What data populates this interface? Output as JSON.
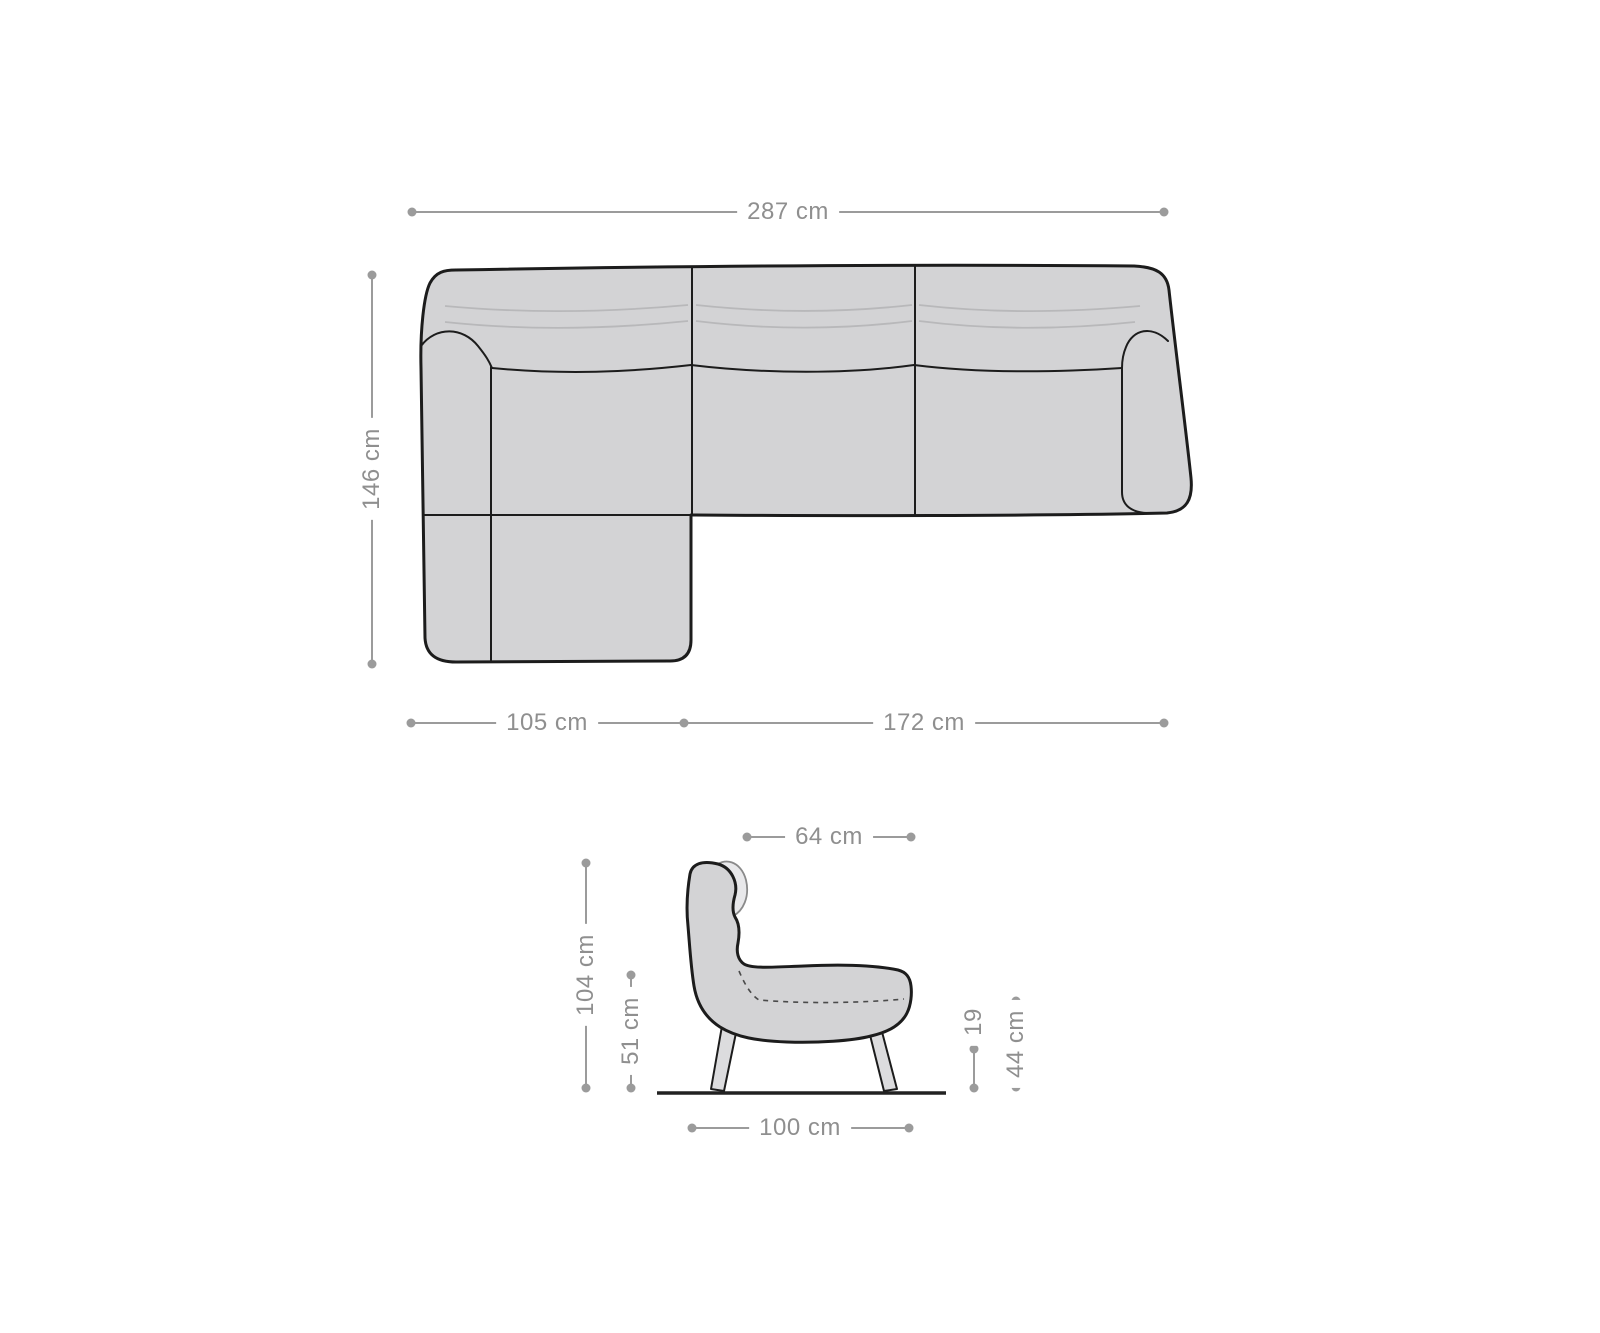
{
  "figure": {
    "title": "furniture-dimension-diagram",
    "colors": {
      "background": "#ffffff",
      "body_fill": "#d3d3d5",
      "body_outline": "#1c1c1c",
      "cushion_fill": "#e8e8ea",
      "cushion_outline": "#8a8a8a",
      "stitch_line": "#b8b8ba",
      "dashed_seam": "#4a4a4a",
      "leg_fill": "#dcdcde",
      "floor_line": "#222222",
      "dimension_line": "#9b9b9b",
      "dimension_text": "#8f8f8f"
    },
    "sofa_top_view": {
      "name": "corner-sofa-top-view",
      "total_width_label": "287 cm",
      "total_depth_label": "146 cm",
      "chaise_width_label": "105 cm",
      "seat_width_label": "172 cm"
    },
    "chair_side_view": {
      "name": "armchair-side-view",
      "depth_top_label": "64 cm",
      "total_height_label": "104 cm",
      "back_seat_height_label": "51 cm",
      "clearance_label": "19",
      "seat_height_label": "44 cm",
      "total_width_label": "100 cm"
    }
  }
}
